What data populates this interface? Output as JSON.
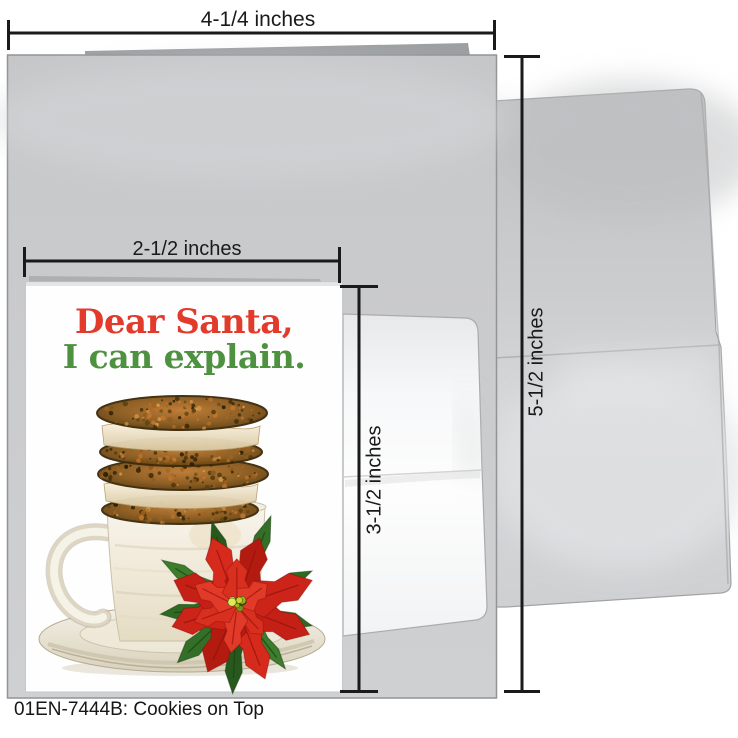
{
  "product": {
    "caption": "01EN-7444B: Cookies on Top",
    "card_title": "Cookies on Top"
  },
  "card_front": {
    "line1": "Dear Santa,",
    "line2": "I can explain."
  },
  "measurements": {
    "outer_width": "4-1/4 inches",
    "front_width": "2-1/2 inches",
    "front_height": "3-1/2 inches",
    "outer_height": "5-1/2 inches"
  },
  "colors": {
    "measure": "#1a1a1a",
    "red": "#e23a2b",
    "green": "#4e9140",
    "card_gray": "#c9cacc",
    "envelope_gray": "#cbccce",
    "cookie_brown": "#8a5a1e",
    "cream": "#f2e7cd",
    "mug_ivory": "#f5f2e7",
    "poinsettia_red": "#cf2419",
    "leaf_green": "#38762a"
  }
}
